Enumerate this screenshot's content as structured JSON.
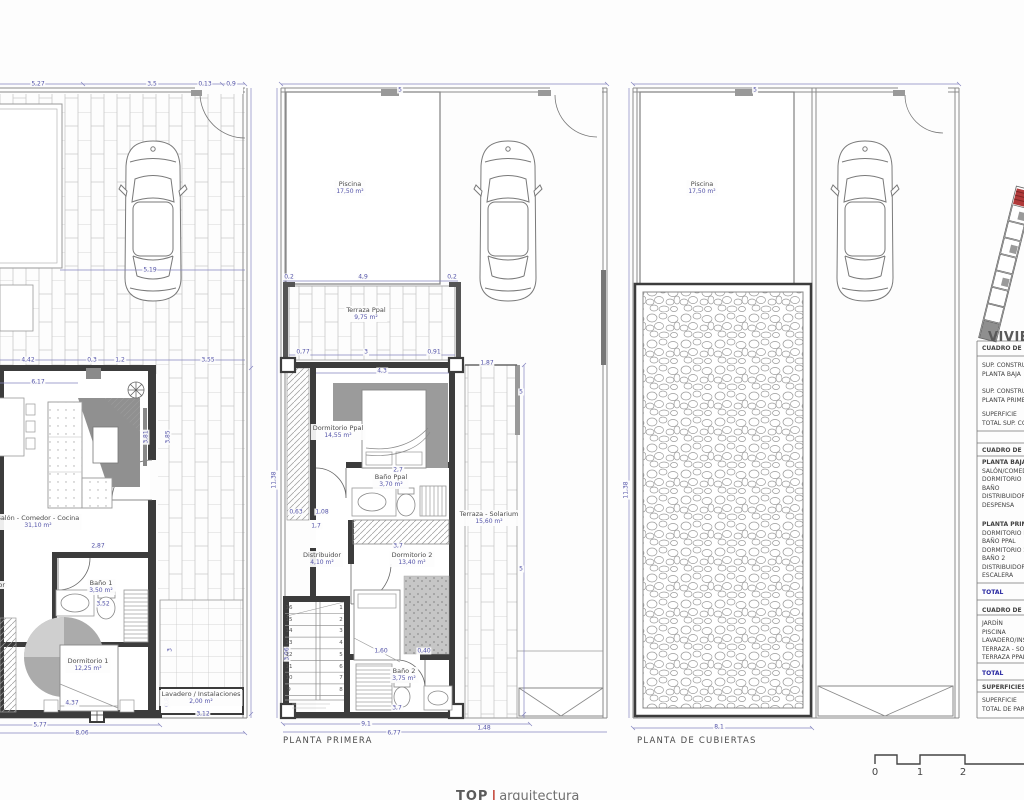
{
  "panels": {
    "baja": {
      "rooms": [
        {
          "name": "Salón - Comedor - Cocina",
          "area": "31,10 m²",
          "x": 38,
          "y": 514
        },
        {
          "name": "Distribuidor",
          "area": "",
          "x": -14,
          "y": 581
        },
        {
          "name": "Baño 1",
          "area": "3,50 m²",
          "x": 101,
          "y": 579
        },
        {
          "name": "Dormitorio 1",
          "area": "12,25 m²",
          "x": 88,
          "y": 657
        },
        {
          "name": "Lavadero / Instalaciones",
          "area": "2,00 m²",
          "x": 201,
          "y": 690
        }
      ]
    },
    "primera": {
      "label": "PLANTA PRIMERA",
      "rooms": [
        {
          "name": "Piscina",
          "area": "17,50 m²",
          "x": 350,
          "y": 180
        },
        {
          "name": "Terraza Ppal",
          "area": "9,75 m²",
          "x": 366,
          "y": 306
        },
        {
          "name": "Dormitorio Ppal",
          "area": "14,55 m²",
          "x": 338,
          "y": 424
        },
        {
          "name": "Baño Ppal",
          "area": "3,70 m²",
          "x": 391,
          "y": 473
        },
        {
          "name": "Distribuidor",
          "area": "4,10 m²",
          "x": 322,
          "y": 551
        },
        {
          "name": "Dormitorio 2",
          "area": "13,40 m²",
          "x": 412,
          "y": 551
        },
        {
          "name": "Baño 2",
          "area": "3,75 m²",
          "x": 404,
          "y": 667
        },
        {
          "name": "Terraza - Solarium",
          "area": "15,60 m²",
          "x": 489,
          "y": 510
        }
      ]
    },
    "cubiertas": {
      "label": "PLANTA DE CUBIERTAS",
      "rooms": [
        {
          "name": "Piscina",
          "area": "17,50 m²",
          "x": 702,
          "y": 180
        }
      ]
    }
  },
  "dimensions": [
    {
      "t": "5,27",
      "x": 38,
      "y": 84
    },
    {
      "t": "3,5",
      "x": 152,
      "y": 84
    },
    {
      "t": "0,13",
      "x": 205,
      "y": 84
    },
    {
      "t": "0,9",
      "x": 231,
      "y": 84
    },
    {
      "t": "5,19",
      "x": 150,
      "y": 270
    },
    {
      "t": "4,42",
      "x": 28,
      "y": 360
    },
    {
      "t": "0,3",
      "x": 92,
      "y": 360
    },
    {
      "t": "1,2",
      "x": 120,
      "y": 360
    },
    {
      "t": "3,55",
      "x": 208,
      "y": 360
    },
    {
      "t": "6,17",
      "x": 38,
      "y": 382
    },
    {
      "t": "3,81",
      "x": 146,
      "y": 437,
      "v": 1
    },
    {
      "t": "3,85",
      "x": 168,
      "y": 437,
      "v": 1
    },
    {
      "t": "2,87",
      "x": 98,
      "y": 546
    },
    {
      "t": "3,52",
      "x": 103,
      "y": 604
    },
    {
      "t": "4,37",
      "x": 72,
      "y": 703
    },
    {
      "t": "5,77",
      "x": 40,
      "y": 725
    },
    {
      "t": "8,06",
      "x": 82,
      "y": 733
    },
    {
      "t": "3,12",
      "x": 203,
      "y": 714
    },
    {
      "t": "3",
      "x": 170,
      "y": 650,
      "v": 1
    },
    {
      "t": "0,8",
      "x": 167,
      "y": 702,
      "v": 1
    },
    {
      "t": "5",
      "x": 400,
      "y": 90
    },
    {
      "t": "0,2",
      "x": 289,
      "y": 277
    },
    {
      "t": "4,9",
      "x": 363,
      "y": 277
    },
    {
      "t": "0,2",
      "x": 452,
      "y": 277
    },
    {
      "t": "0,77",
      "x": 303,
      "y": 352
    },
    {
      "t": "3",
      "x": 366,
      "y": 352
    },
    {
      "t": "0,91",
      "x": 434,
      "y": 352
    },
    {
      "t": "4,3",
      "x": 382,
      "y": 371
    },
    {
      "t": "2,7",
      "x": 398,
      "y": 470
    },
    {
      "t": "0,63",
      "x": 296,
      "y": 512
    },
    {
      "t": "1,08",
      "x": 322,
      "y": 512
    },
    {
      "t": "1,7",
      "x": 316,
      "y": 526
    },
    {
      "t": "3,7",
      "x": 398,
      "y": 546
    },
    {
      "t": "1,60",
      "x": 381,
      "y": 651
    },
    {
      "t": "0,40",
      "x": 424,
      "y": 651
    },
    {
      "t": "3,7",
      "x": 397,
      "y": 708
    },
    {
      "t": "9,1",
      "x": 366,
      "y": 724
    },
    {
      "t": "6,77",
      "x": 394,
      "y": 733
    },
    {
      "t": "1,48",
      "x": 484,
      "y": 728
    },
    {
      "t": "1,87",
      "x": 487,
      "y": 363
    },
    {
      "t": "5",
      "x": 521,
      "y": 392
    },
    {
      "t": "5",
      "x": 521,
      "y": 569
    },
    {
      "t": "3,06",
      "x": 287,
      "y": 654,
      "v": 1
    },
    {
      "t": "11,38",
      "x": 274,
      "y": 480,
      "v": 1
    },
    {
      "t": "5",
      "x": 755,
      "y": 90
    },
    {
      "t": "8,1",
      "x": 719,
      "y": 727
    },
    {
      "t": "11,38",
      "x": 626,
      "y": 490,
      "v": 1
    }
  ],
  "stairs": {
    "right": [
      "1",
      "2",
      "3",
      "4",
      "5",
      "6",
      "7",
      "8"
    ],
    "left": [
      "16",
      "15",
      "14",
      "13",
      "12",
      "11",
      "10",
      "9"
    ]
  },
  "legend": {
    "title": "VIVIENDA",
    "rows": [
      {
        "y": 344,
        "c": "hdr",
        "l": [
          "CUADRO DE SUPERFICIES"
        ]
      },
      {
        "y": 361,
        "c": "row",
        "l": [
          "SUP. CONSTRUIDA",
          "PLANTA BAJA"
        ]
      },
      {
        "y": 387,
        "c": "row",
        "l": [
          "SUP. CONSTRUIDA",
          "PLANTA PRIMERA"
        ]
      },
      {
        "y": 410,
        "c": "row",
        "l": [
          "SUPERFICIE",
          "TOTAL SUP. CONSTRUIDA"
        ]
      },
      {
        "y": 446,
        "c": "hdr",
        "l": [
          "CUADRO DE SUPERFICIES ÚTILES"
        ]
      },
      {
        "y": 458,
        "c": "bold",
        "l": [
          "PLANTA BAJA"
        ]
      },
      {
        "y": 467,
        "c": "row",
        "l": [
          "SALÓN/COMEDOR"
        ]
      },
      {
        "y": 475,
        "c": "row",
        "l": [
          "DORMITORIO 1"
        ]
      },
      {
        "y": 484,
        "c": "row",
        "l": [
          "BAÑO"
        ]
      },
      {
        "y": 492,
        "c": "row",
        "l": [
          "DISTRIBUIDOR"
        ]
      },
      {
        "y": 501,
        "c": "row",
        "l": [
          "DESPENSA"
        ]
      },
      {
        "y": 520,
        "c": "bold",
        "l": [
          "PLANTA PRIMERA"
        ]
      },
      {
        "y": 529,
        "c": "row",
        "l": [
          "DORMITORIO PPAL"
        ]
      },
      {
        "y": 537,
        "c": "row",
        "l": [
          "BAÑO PPAL"
        ]
      },
      {
        "y": 546,
        "c": "row",
        "l": [
          "DORMITORIO 2"
        ]
      },
      {
        "y": 554,
        "c": "row",
        "l": [
          "BAÑO 2"
        ]
      },
      {
        "y": 563,
        "c": "row",
        "l": [
          "DISTRIBUIDOR"
        ]
      },
      {
        "y": 571,
        "c": "row",
        "l": [
          "ESCALERA"
        ]
      },
      {
        "y": 588,
        "c": "total",
        "l": [
          "TOTAL"
        ]
      },
      {
        "y": 606,
        "c": "hdr",
        "l": [
          "CUADRO DE SUPERFICIES"
        ]
      },
      {
        "y": 619,
        "c": "row",
        "l": [
          "JARDÍN"
        ]
      },
      {
        "y": 628,
        "c": "row",
        "l": [
          "PISCINA"
        ]
      },
      {
        "y": 636,
        "c": "row",
        "l": [
          "LAVADERO/INSTALACIONES"
        ]
      },
      {
        "y": 645,
        "c": "row",
        "l": [
          "TERRAZA - SOLARIUM"
        ]
      },
      {
        "y": 653,
        "c": "row",
        "l": [
          "TERRAZA PPAL"
        ]
      },
      {
        "y": 669,
        "c": "total",
        "l": [
          "TOTAL"
        ]
      },
      {
        "y": 683,
        "c": "hdr",
        "l": [
          "SUPERFICIES"
        ]
      },
      {
        "y": 696,
        "c": "row",
        "l": [
          "SUPERFICIE",
          "TOTAL DE PARCELA"
        ]
      }
    ]
  },
  "scalebar": {
    "labels": [
      "0",
      "1",
      "2"
    ]
  },
  "logo": {
    "left": "TOP",
    "sep": "|",
    "right": "arquitectura"
  }
}
